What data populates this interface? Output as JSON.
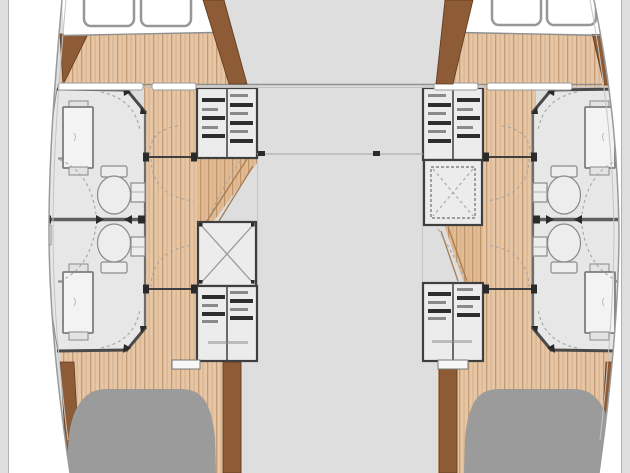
{
  "meta": {
    "title": "Catamaran interior floor plan — forward cabins, top view"
  },
  "colors": {
    "background": "#dedede",
    "hullWhite": "#ffffff",
    "outline": "#9a9a9a",
    "wallDark": "#4a4a4a",
    "wallMid": "#6e6e6e",
    "roomFill": "#e7e7e7",
    "fixtureFill": "#f3f3f3",
    "fixtureStroke": "#7d7d7d",
    "woodBase": "#e6c6a4",
    "woodStripeA": "#c49b72",
    "woodStripeB": "#d6b08a",
    "woodStepsBase": "#e2bb93",
    "woodStepsStripe": "#bf9468",
    "beamBrown": "#8d5b35",
    "beamEdge": "#5f3a1e",
    "unitFill": "#ececec",
    "unitStroke": "#3f3f3f",
    "barDark": "#2e2e2e",
    "barLight": "#8a8a8a",
    "xLine": "#9a9a9a",
    "dashLine": "#a5a5a5",
    "seatGray": "#9b9b9b",
    "ledgeFill": "#ffffff"
  },
  "plan": {
    "type": "catamaran-floor-plan",
    "view": "top-down",
    "bow_deck_hatches": 4,
    "hull_suites": [
      {
        "side": "port",
        "rooms": 2,
        "fixtures_per_room": [
          "washbasin-unit",
          "toilet",
          "door-swing-arc"
        ]
      },
      {
        "side": "starboard",
        "rooms": 2,
        "fixtures_per_room": [
          "washbasin-unit",
          "toilet",
          "door-swing-arc"
        ]
      }
    ],
    "companionways": [
      {
        "side": "port",
        "elements": [
          "drawer-locker",
          "steps",
          "x-marked-locker",
          "drawer-locker"
        ]
      },
      {
        "side": "starboard",
        "elements": [
          "drawer-locker",
          "x-marked-locker",
          "steps",
          "drawer-locker"
        ]
      }
    ],
    "sliding_doors_per_hull": 2,
    "deck_seats": 2
  }
}
